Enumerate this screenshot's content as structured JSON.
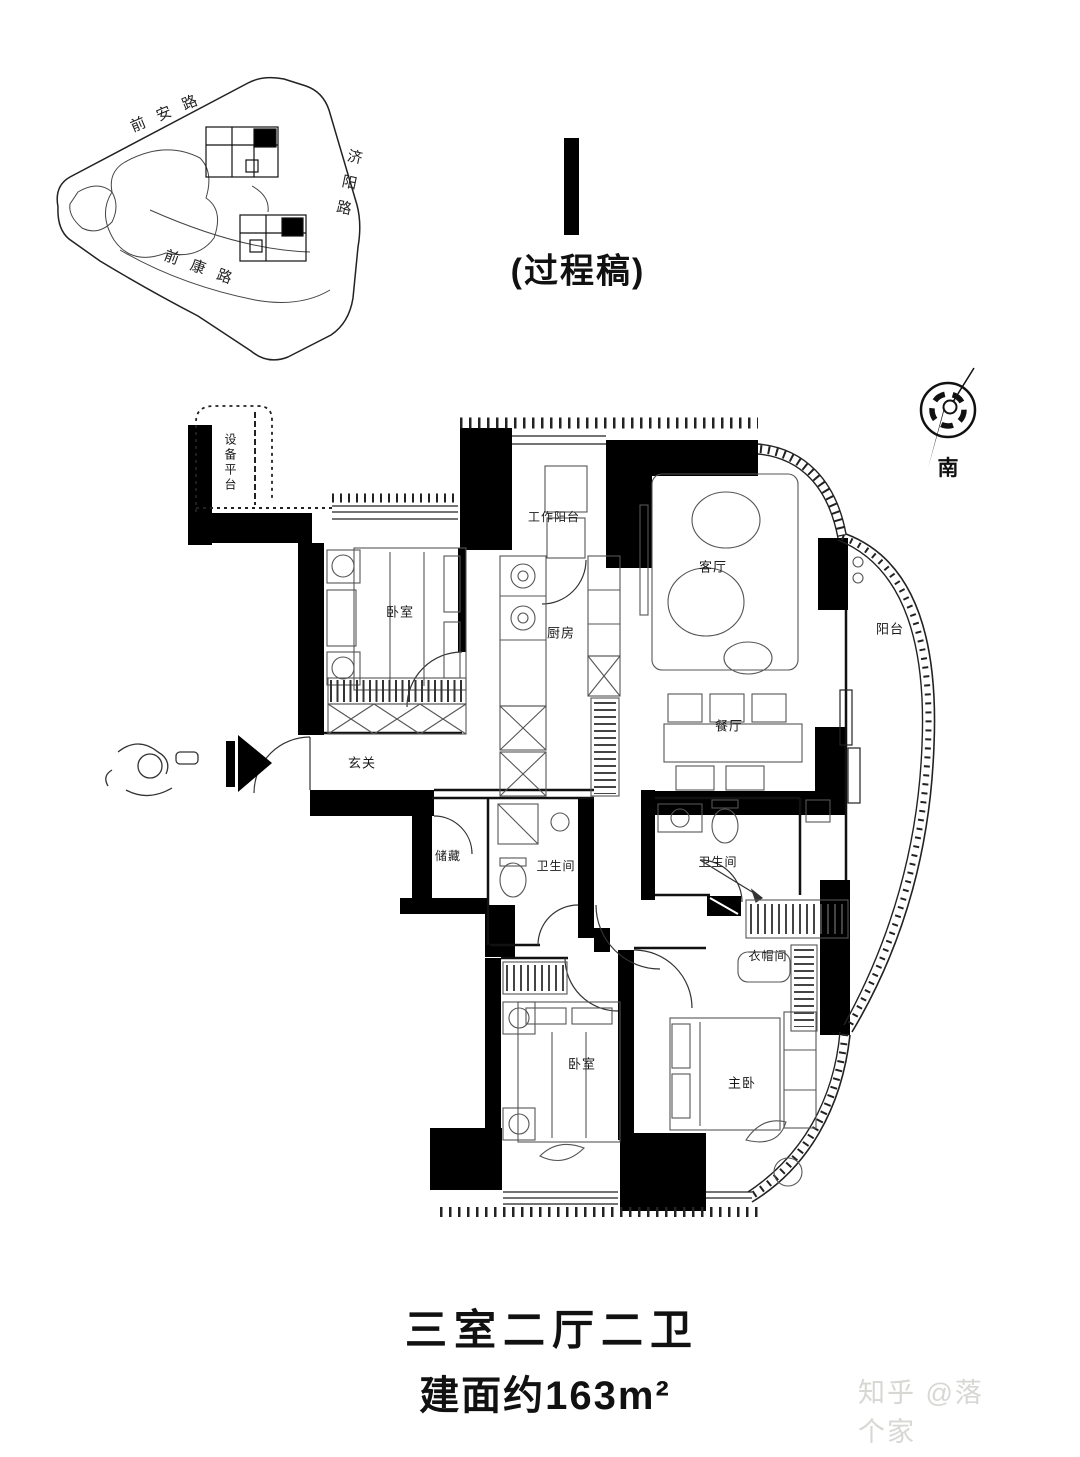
{
  "site_plan": {
    "road_top": "前安路",
    "road_right": "济阳路",
    "road_bottom": "前康路"
  },
  "draft_mark": {
    "label": "(过程稿)"
  },
  "compass": {
    "south": "南"
  },
  "floor_plan": {
    "rooms": [
      {
        "id": "equipment-platform",
        "label": "设备平台"
      },
      {
        "id": "bedroom-1",
        "label": "卧室"
      },
      {
        "id": "work-balcony",
        "label": "工作阳台"
      },
      {
        "id": "kitchen",
        "label": "厨房"
      },
      {
        "id": "living-room",
        "label": "客厅"
      },
      {
        "id": "balcony",
        "label": "阳台"
      },
      {
        "id": "dining-room",
        "label": "餐厅"
      },
      {
        "id": "entry",
        "label": "玄关"
      },
      {
        "id": "storage",
        "label": "储藏"
      },
      {
        "id": "bathroom-1",
        "label": "卫生间"
      },
      {
        "id": "bathroom-2",
        "label": "卫生间"
      },
      {
        "id": "walk-in-closet",
        "label": "衣帽间"
      },
      {
        "id": "bedroom-2",
        "label": "卧室"
      },
      {
        "id": "master-bedroom",
        "label": "主卧"
      }
    ]
  },
  "summary": {
    "layout": "三室二厅二卫",
    "area": "建面约163m²"
  },
  "watermark": {
    "text": "知乎 @落个家"
  },
  "colors": {
    "wall": "#000000",
    "line": "#555555",
    "watermark": "#d7d7d4"
  }
}
